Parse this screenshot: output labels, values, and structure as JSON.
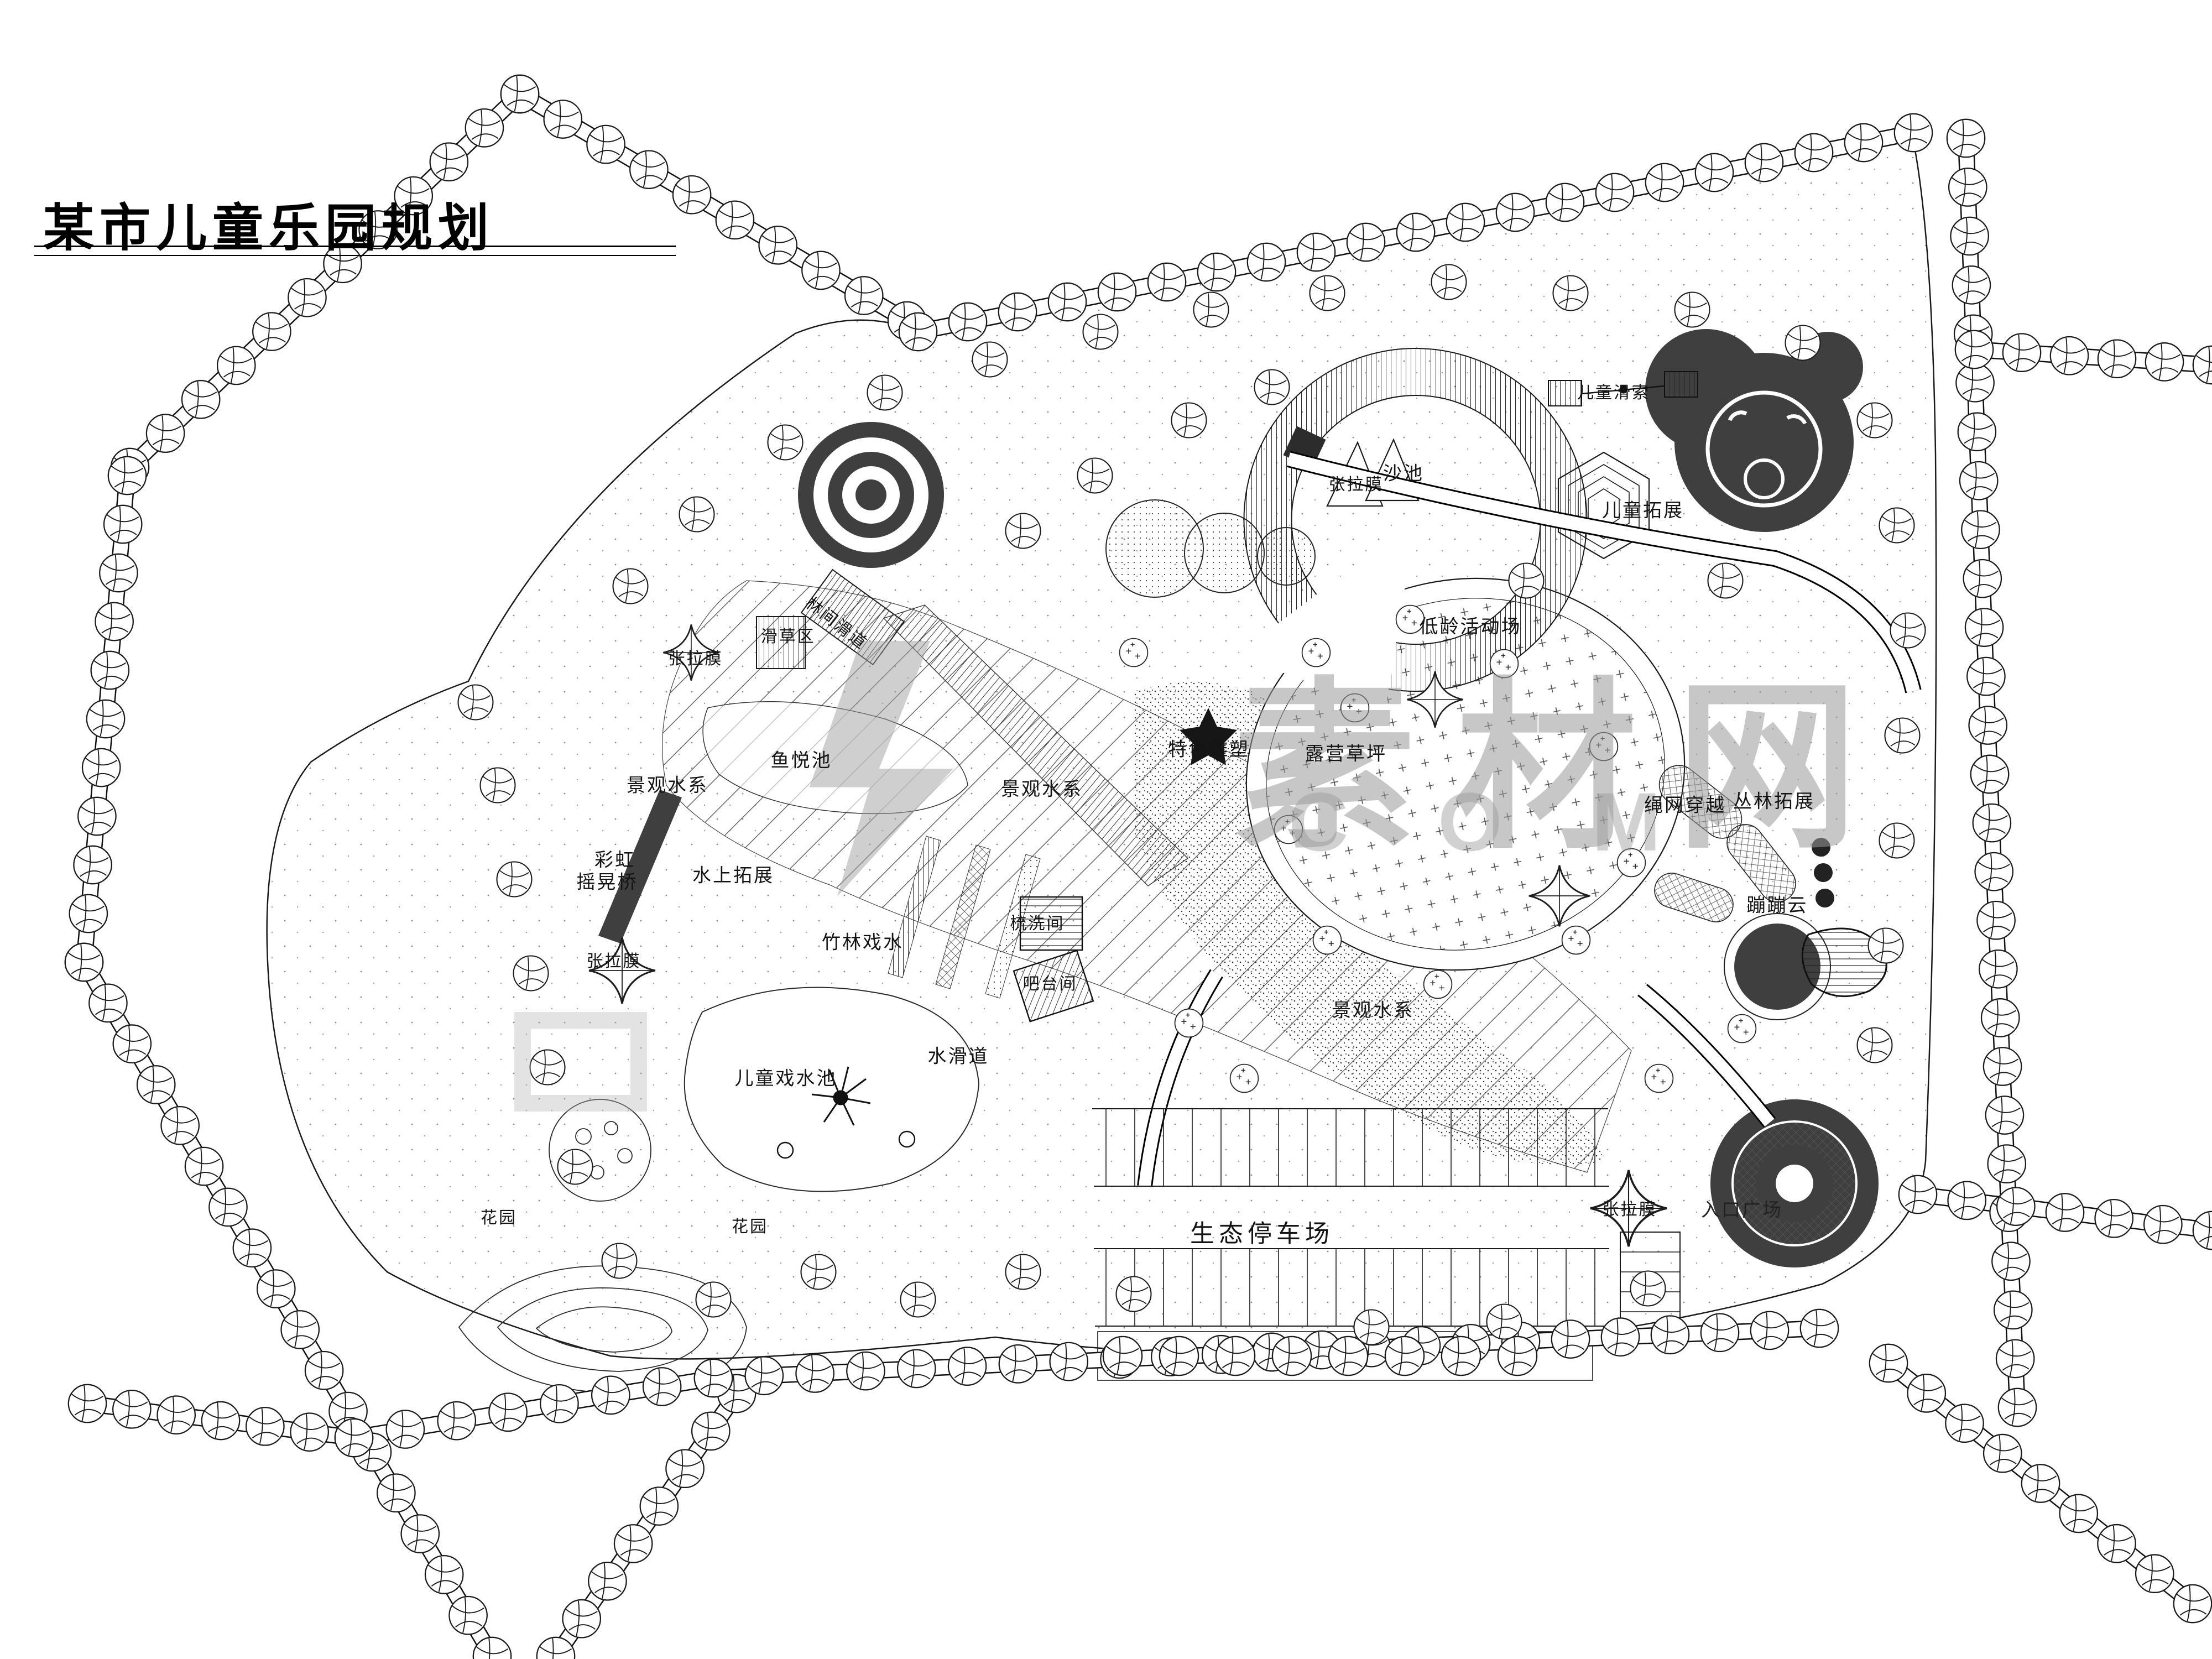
{
  "title": "某市儿童乐园规划",
  "watermark": {
    "cn": "素材网",
    "en": "C O M"
  },
  "colors": {
    "ink": "#1a1a1a",
    "dark_fill": "#3f3f3f",
    "watermark_gray": "#9a9a9a"
  },
  "labels": {
    "slide_grass": "滑草区",
    "slide_forest": "林间滑道",
    "membrane": "张拉膜",
    "fish_pond": "鱼悦池",
    "waterscape": "景观水系",
    "rainbow_line1": "彩虹",
    "rainbow_line2": "摇晃桥",
    "water_challenge": "水上拓展",
    "bamboo_water": "竹林戏水",
    "wash_room": "梳洗间",
    "bar_kiosk": "吧台间",
    "kids_pool": "儿童戏水池",
    "water_slide": "水滑道",
    "garden": "花园",
    "eco_parking": "生态停车场",
    "entrance_plaza": "入口广场",
    "bouncing_cloud": "蹦蹦云",
    "rope_net": "绳网穿越",
    "jungle_expand": "丛林拓展",
    "toddler_area": "低龄活动场",
    "sand_pit": "沙池",
    "kids_expand": "儿童拓展",
    "sculpture": "特色雕塑",
    "camping_lawn": "露营草坪",
    "kids_zipline": "儿童滑索"
  }
}
